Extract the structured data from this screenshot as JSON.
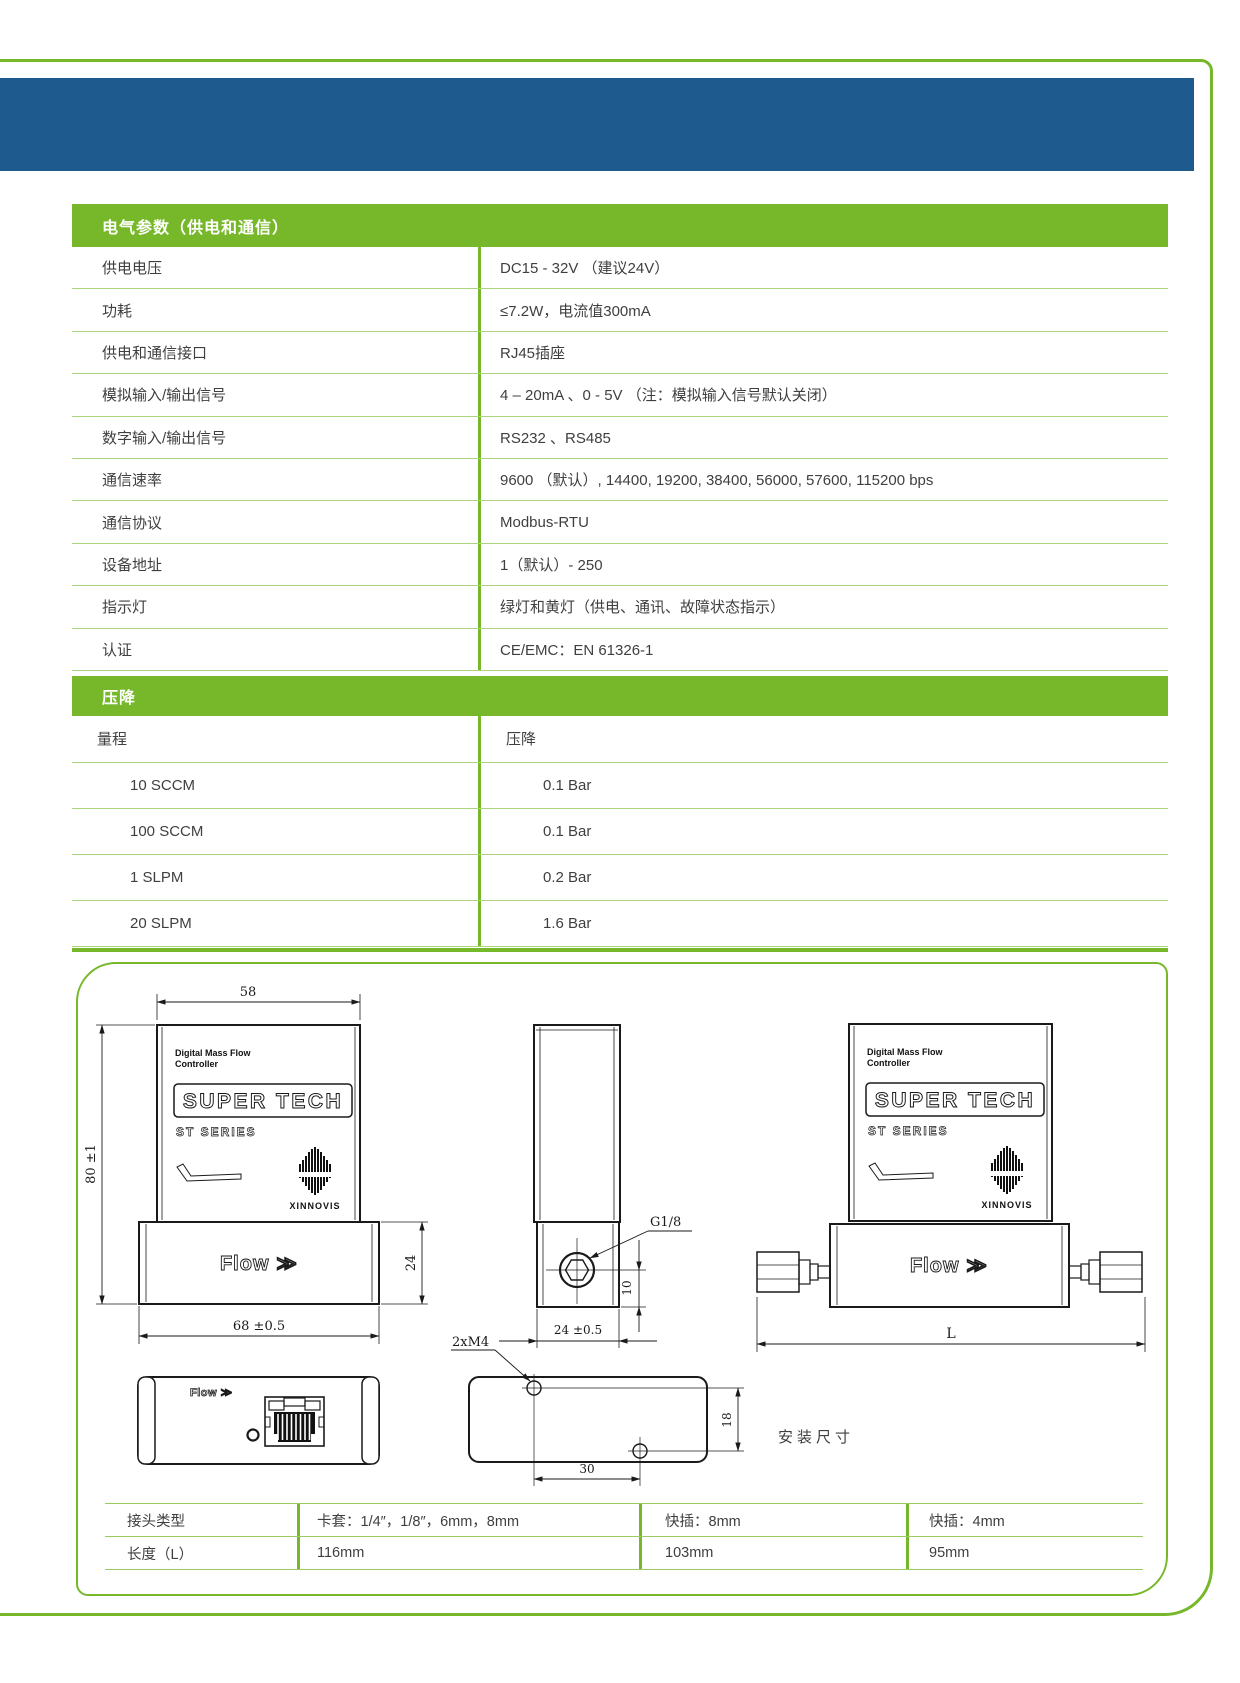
{
  "colors": {
    "green": "#76b829",
    "light_green_line": "#abd379",
    "blue": "#1e5a8d",
    "text": "#3f3f3f"
  },
  "electrical": {
    "title": "电气参数（供电和通信）",
    "rows": [
      {
        "label": "供电电压",
        "value": "DC15 - 32V （建议24V）"
      },
      {
        "label": "功耗",
        "value": "≤7.2W，电流值300mA"
      },
      {
        "label": "供电和通信接口",
        "value": "RJ45插座"
      },
      {
        "label": "模拟输入/输出信号",
        "value": "4 – 20mA 、0 - 5V （注：模拟输入信号默认关闭）"
      },
      {
        "label": "数字输入/输出信号",
        "value": "RS232 、RS485"
      },
      {
        "label": "通信速率",
        "value": "9600 （默认）, 14400, 19200, 38400, 56000, 57600, 115200 bps"
      },
      {
        "label": "通信协议",
        "value": "Modbus-RTU"
      },
      {
        "label": "设备地址",
        "value": "1（默认）- 250"
      },
      {
        "label": "指示灯",
        "value": "绿灯和黄灯（供电、通讯、故障状态指示）"
      },
      {
        "label": "认证",
        "value": "CE/EMC：EN 61326-1"
      }
    ]
  },
  "pressure_drop": {
    "title": "压降",
    "col_range": "量程",
    "col_drop": "压降",
    "rows": [
      {
        "range": "10 SCCM",
        "drop": "0.1 Bar"
      },
      {
        "range": "100 SCCM",
        "drop": "0.1 Bar"
      },
      {
        "range": "1  SLPM",
        "drop": "0.2 Bar"
      },
      {
        "range": "20 SLPM",
        "drop": "1.6 Bar"
      }
    ]
  },
  "drawing": {
    "dims": {
      "w58": "58",
      "h80": "80  ±1",
      "h24": "24",
      "w68": "68  ±0.5",
      "g18": "G1/8",
      "d10": "10",
      "w24": "24  ±0.5",
      "m4": "2xM4",
      "d30": "30",
      "d18": "18",
      "L": "L"
    },
    "install": "安装尺寸",
    "brand": {
      "line1": "Digital Mass Flow",
      "line2": "Controller",
      "logo": "SUPER TECH",
      "series": "ST SERIES",
      "maker": "XINNOVIS",
      "flow": "Flow ≫"
    }
  },
  "connector_table": {
    "rows": [
      {
        "label": "接头类型",
        "c1": "卡套：1/4″，1/8″，6mm，8mm",
        "c2": "快插：8mm",
        "c3": "快插：4mm"
      },
      {
        "label": "长度（L）",
        "c1": "116mm",
        "c2": "103mm",
        "c3": "95mm"
      }
    ]
  }
}
